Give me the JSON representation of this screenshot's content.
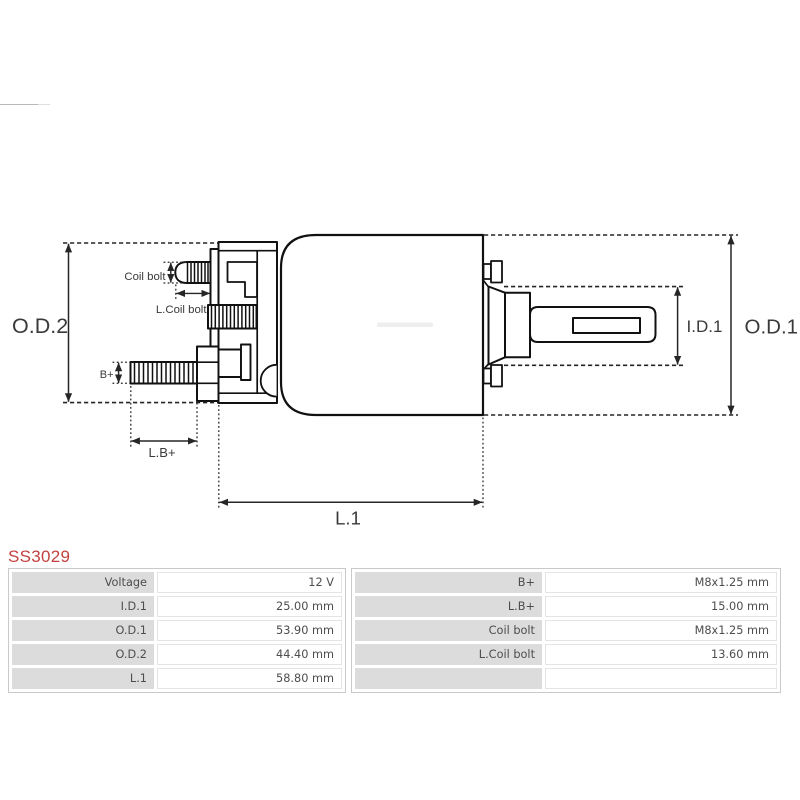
{
  "part_number": "SS3029",
  "accent_color": "#c24240",
  "diagram": {
    "line_color": "#1a1a1a",
    "dim_color": "#262626",
    "labels": {
      "od2": "O.D.2",
      "od1": "O.D.1",
      "id1": "I.D.1",
      "l1": "L.1",
      "lb_plus": "L.B+",
      "b_plus": "B+",
      "coil_bolt": "Coil bolt",
      "l_coil_bolt": "L.Coil bolt"
    }
  },
  "spec_table": {
    "left": {
      "rows": [
        {
          "label": "Voltage",
          "value": "12 V"
        },
        {
          "label": "I.D.1",
          "value": "25.00 mm"
        },
        {
          "label": "O.D.1",
          "value": "53.90 mm"
        },
        {
          "label": "O.D.2",
          "value": "44.40 mm"
        },
        {
          "label": "L.1",
          "value": "58.80 mm"
        }
      ]
    },
    "right": {
      "rows": [
        {
          "label": "B+",
          "value": "M8x1.25 mm"
        },
        {
          "label": "L.B+",
          "value": "15.00 mm"
        },
        {
          "label": "Coil bolt",
          "value": "M8x1.25 mm"
        },
        {
          "label": "L.Coil bolt",
          "value": "13.60 mm"
        },
        {
          "label": "",
          "value": ""
        }
      ]
    }
  }
}
